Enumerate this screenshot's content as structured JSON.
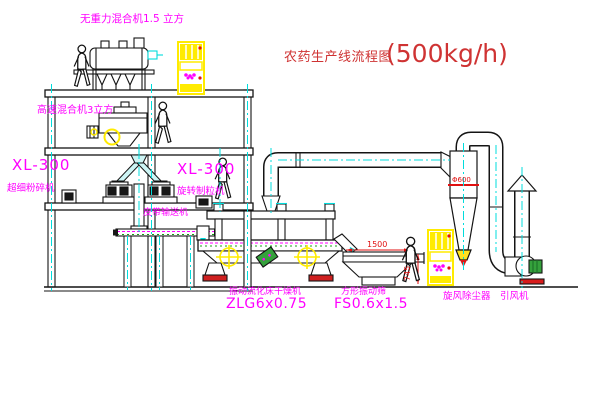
{
  "title": {
    "name": "农药生产线流程图",
    "capacity": "(500kg/h)"
  },
  "equipment_labels": {
    "gravity_mixer": "无重力混合机1.5 立方",
    "high_speed_mixer": "高速混合机3立方",
    "pulverizer_model": "XL-300",
    "pulverizer_name": "超细粉碎机",
    "granulator_model": "XL-300",
    "granulator_name": "旋转制粒机",
    "belt_conveyor": "皮带输送机",
    "dryer_name": "振动流化床干燥机",
    "dryer_model": "ZLG6x0.75",
    "sieve_name": "方形振动筛",
    "sieve_model": "FS0.6x1.5",
    "cyclone_name": "旋风除尘器",
    "fan_name": "引风机"
  },
  "dimensions": {
    "sieve_length": "1500",
    "sieve_height": "745",
    "cyclone_dia": "Φ600"
  },
  "colors": {
    "line": "#141414",
    "centerline_cyan": "#00dcdc",
    "label_magenta": "#ff00ff",
    "cabinet_yellow": "#ffeb00",
    "dimension_red": "#e01010",
    "title_red": "#cf3333",
    "motor_green": "#35a13c"
  }
}
